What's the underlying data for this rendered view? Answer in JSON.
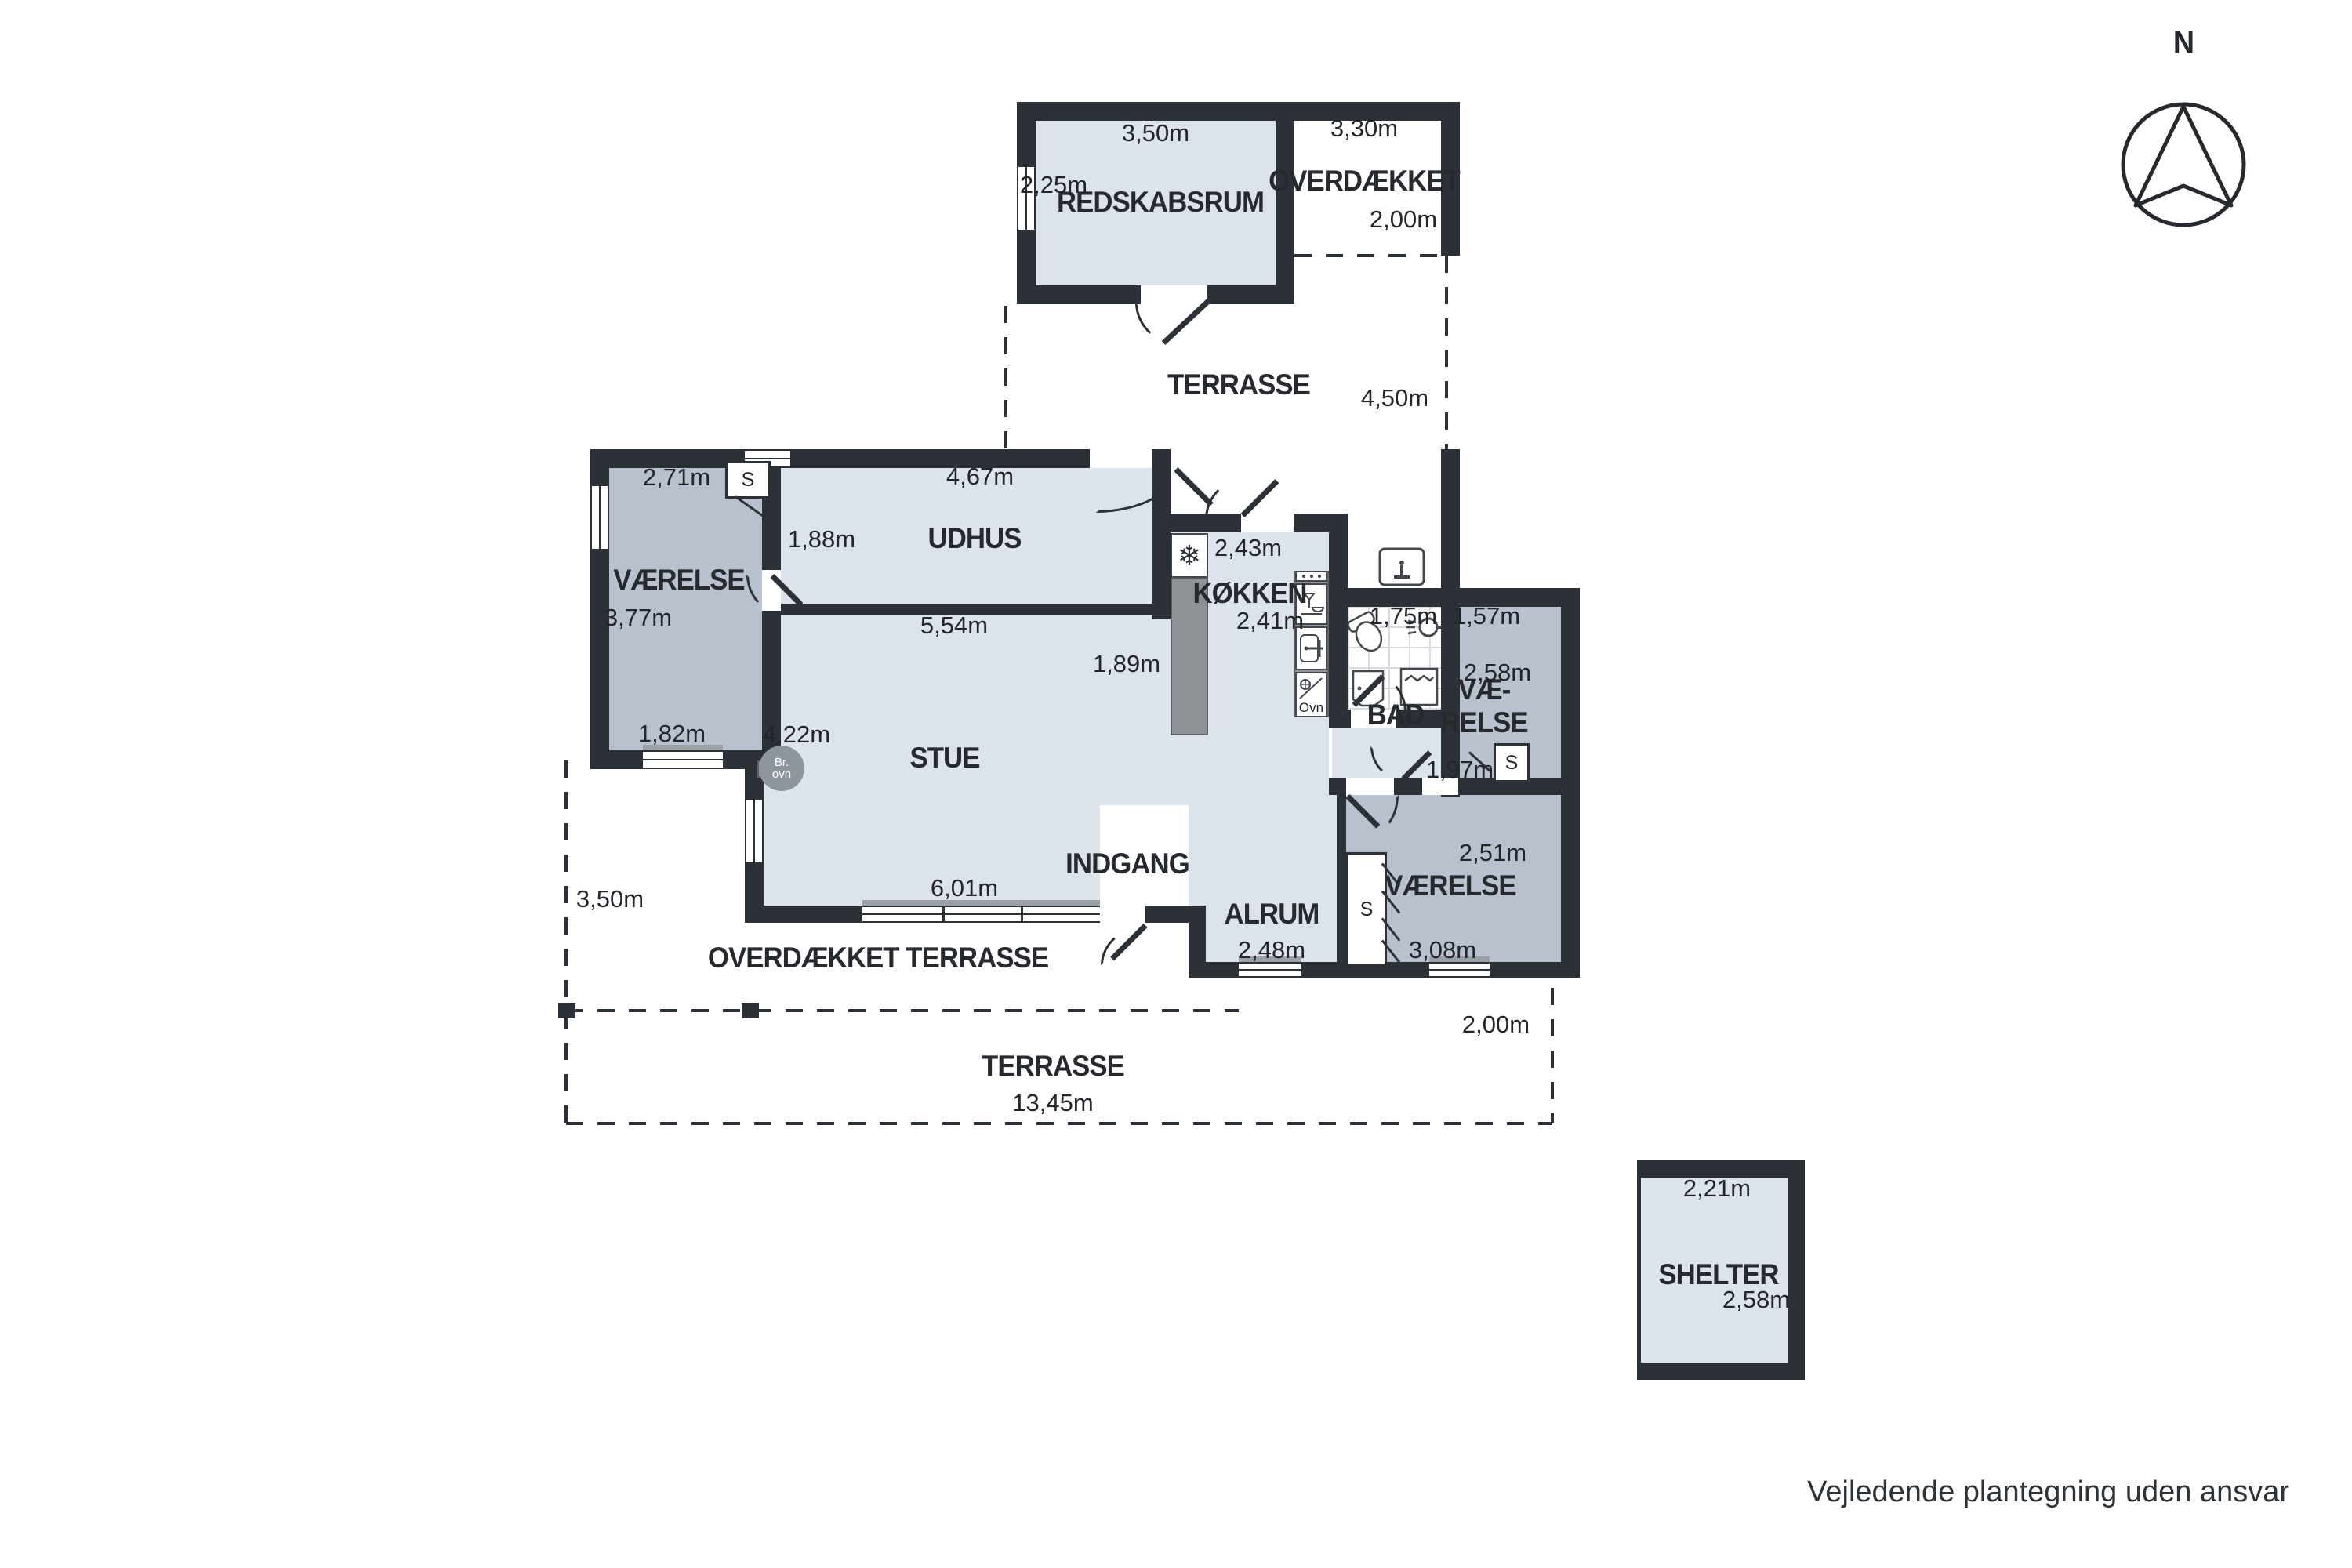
{
  "compass": {
    "north_label": "N"
  },
  "footer": {
    "disclaimer": "Vejledende plantegning uden ansvar"
  },
  "outbuilding": {
    "redskabsrum": {
      "label": "REDSKABSRUM",
      "width": "3,50m",
      "depth": "2,25m"
    },
    "overdaekket": {
      "label": "OVERDÆKKET",
      "width": "3,30m",
      "depth": "2,00m"
    }
  },
  "yard": {
    "terrasse_upper": {
      "label": "TERRASSE",
      "gap_to_house": "4,50m"
    },
    "overdaekket_terrasse": {
      "label": "OVERDÆKKET TERRASSE",
      "west_depth": "3,50m"
    },
    "terrasse_lower": {
      "label": "TERRASSE",
      "width": "13,45m",
      "east_depth": "2,00m"
    },
    "shelter": {
      "label": "SHELTER",
      "width": "2,21m",
      "depth": "2,58m"
    }
  },
  "house": {
    "vaerelse_nw": {
      "label": "VÆRELSE",
      "width": "2,71m",
      "depth": "3,77m",
      "bottom_width": "1,82m",
      "closet": "S"
    },
    "udhus": {
      "label": "UDHUS",
      "width": "4,67m",
      "depth": "1,88m"
    },
    "stue": {
      "label": "STUE",
      "top_width": "5,54m",
      "east_depth": "1,89m",
      "west_depth": "4,22m",
      "window_width": "6,01m",
      "stove_line1": "Br.",
      "stove_line2": "ovn"
    },
    "koekken": {
      "label": "KØKKEN",
      "width": "2,43m",
      "depth": "2,41m",
      "oven": "Ovn"
    },
    "bad": {
      "label": "BAD",
      "width": "1,75m"
    },
    "vaerelse_e": {
      "label_line1": "VÆ-",
      "label_line2": "RELSE",
      "width": "1,57m",
      "depth": "2,58m",
      "bottom_width": "1,97m",
      "closet": "S"
    },
    "indgang": {
      "label": "INDGANG"
    },
    "alrum": {
      "label": "ALRUM",
      "width": "2,48m"
    },
    "vaerelse_se": {
      "label": "VÆRELSE",
      "width": "3,08m",
      "depth": "2,51m",
      "closet": "S"
    }
  }
}
